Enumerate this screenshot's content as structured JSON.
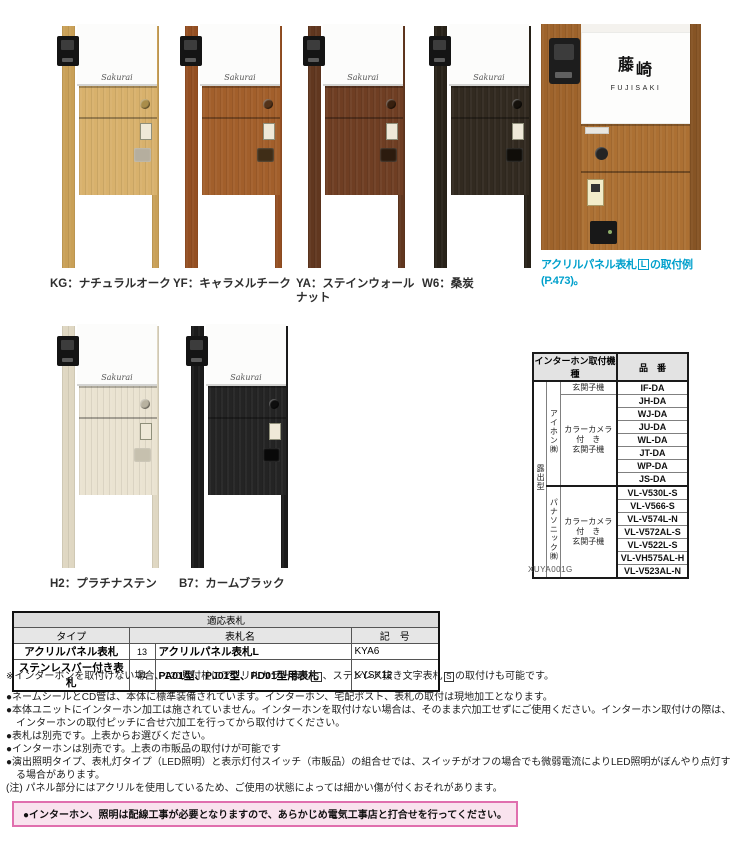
{
  "colors_css": "--accent:#00a0cc;--warn-border:#e06fae;--warn-bg:#f9e3ee",
  "decor": {
    "signature": "Sakurai"
  },
  "products_row1": [
    {
      "label": "KG：ナチュラルオーク",
      "css": "--wood:#d8b16c;--post:#c9a057;--knob:#a98d4a;--lock:#b5ae9e"
    },
    {
      "label": "YF：キャラメルチーク",
      "css": "--wood:#a25f2b;--post:#944f22;--knob:#53331a;--lock:#3f2d17"
    },
    {
      "label": "YA：ステインウォールナット",
      "css": "--wood:#6f3e23;--post:#61371f;--knob:#38200f;--lock:#2c1b0e"
    },
    {
      "label": "W6：桑炭",
      "css": "--wood:#322a20;--post:#282219;--knob:#15110c;--lock:#100d09"
    }
  ],
  "products_row2": [
    {
      "label": "H2：プラチナステン",
      "css": "--wood:#eae3d1;--post:#dfd7c2;--knob:#b8b2a0;--lock:#c6c0ae"
    },
    {
      "label": "B7：カームブラック",
      "css": "--wood:#242424;--post:#1b1b1b;--knob:#0e0e0e;--lock:#090909"
    }
  ],
  "example": {
    "css": "--wood:#ac7033;--post:#9e632b",
    "kanji_top": "藤",
    "kanji_bottom": "崎",
    "roman": "FUJISAKI",
    "caption_pre": "アクリルパネル表札",
    "caption_box": "L",
    "caption_post": "の取付例 (P.473)。"
  },
  "intercom_table": {
    "title": "インターホン取付機種",
    "part_header": "品　番",
    "mount_type": "露出型",
    "maker1": "アイホン㈱",
    "maker2": "パナソニック㈱",
    "type1": "玄関子機",
    "type2": "カラーカメラ\n付　き\n玄関子機",
    "type3": "カラーカメラ\n付　き\n玄関子機",
    "models": [
      "IF-DA",
      "JH-DA",
      "WJ-DA",
      "JU-DA",
      "WL-DA",
      "JT-DA",
      "WP-DA",
      "JS-DA",
      "VL-V530L-S",
      "VL-V566-S",
      "VL-V574L-N",
      "VL-V572AL-S",
      "VL-V522L-S",
      "VL-VH575AL-H",
      "VL-V523AL-N"
    ],
    "code": "XUYA001G"
  },
  "nameplate_table": {
    "title": "適応表札",
    "col_type": "タイプ",
    "col_name": "表札名",
    "col_code": "記　号",
    "rows": [
      {
        "type": "アクリルパネル表札",
        "page": "13",
        "name": "アクリルパネル表札L",
        "code": "KYA6"
      },
      {
        "type": "ステンレスバー付き表札",
        "page": "31",
        "name": "PA01型、PJ01型、PD01型用表札",
        "code": "KYSK12"
      }
    ]
  },
  "notes": {
    "s_note": {
      "pre": "※インターホンを取付けない場合、120見付柱にアクリルカラー表札",
      "box1": "S",
      "mid": "、ステンレス抜き文字表札",
      "box2": "S",
      "post": "の取付けも可能です。"
    },
    "bullets": [
      "●ネームシールとCD管は、本体に標準装備されています。インターホン、宅配ポスト、表札の取付は現地加工となります。",
      "●本体ユニットにインターホン加工は施されていません。インターホンを取付けない場合は、そのまま穴加工せずにご使用ください。インターホン取付けの際は、インターホンの取付ピッチに合せ穴加工を行ってから取付けてください。",
      "●表札は別売です。上表からお選びください。",
      "●インターホンは別売です。上表の市販品の取付けが可能です",
      "●演出照明タイプ、表札灯タイプ（LED照明）と表示灯付スイッチ（市販品）の組合せでは、スイッチがオフの場合でも微弱電流によりLED照明がぼんやり点灯する場合があります。",
      "(注) パネル部分にはアクリルを使用しているため、ご使用の状態によっては細かい傷が付くおそれがあります。"
    ],
    "warning": "●インターホン、照明は配線工事が必要となりますので、あらかじめ電気工事店と打合せを行ってください。"
  }
}
